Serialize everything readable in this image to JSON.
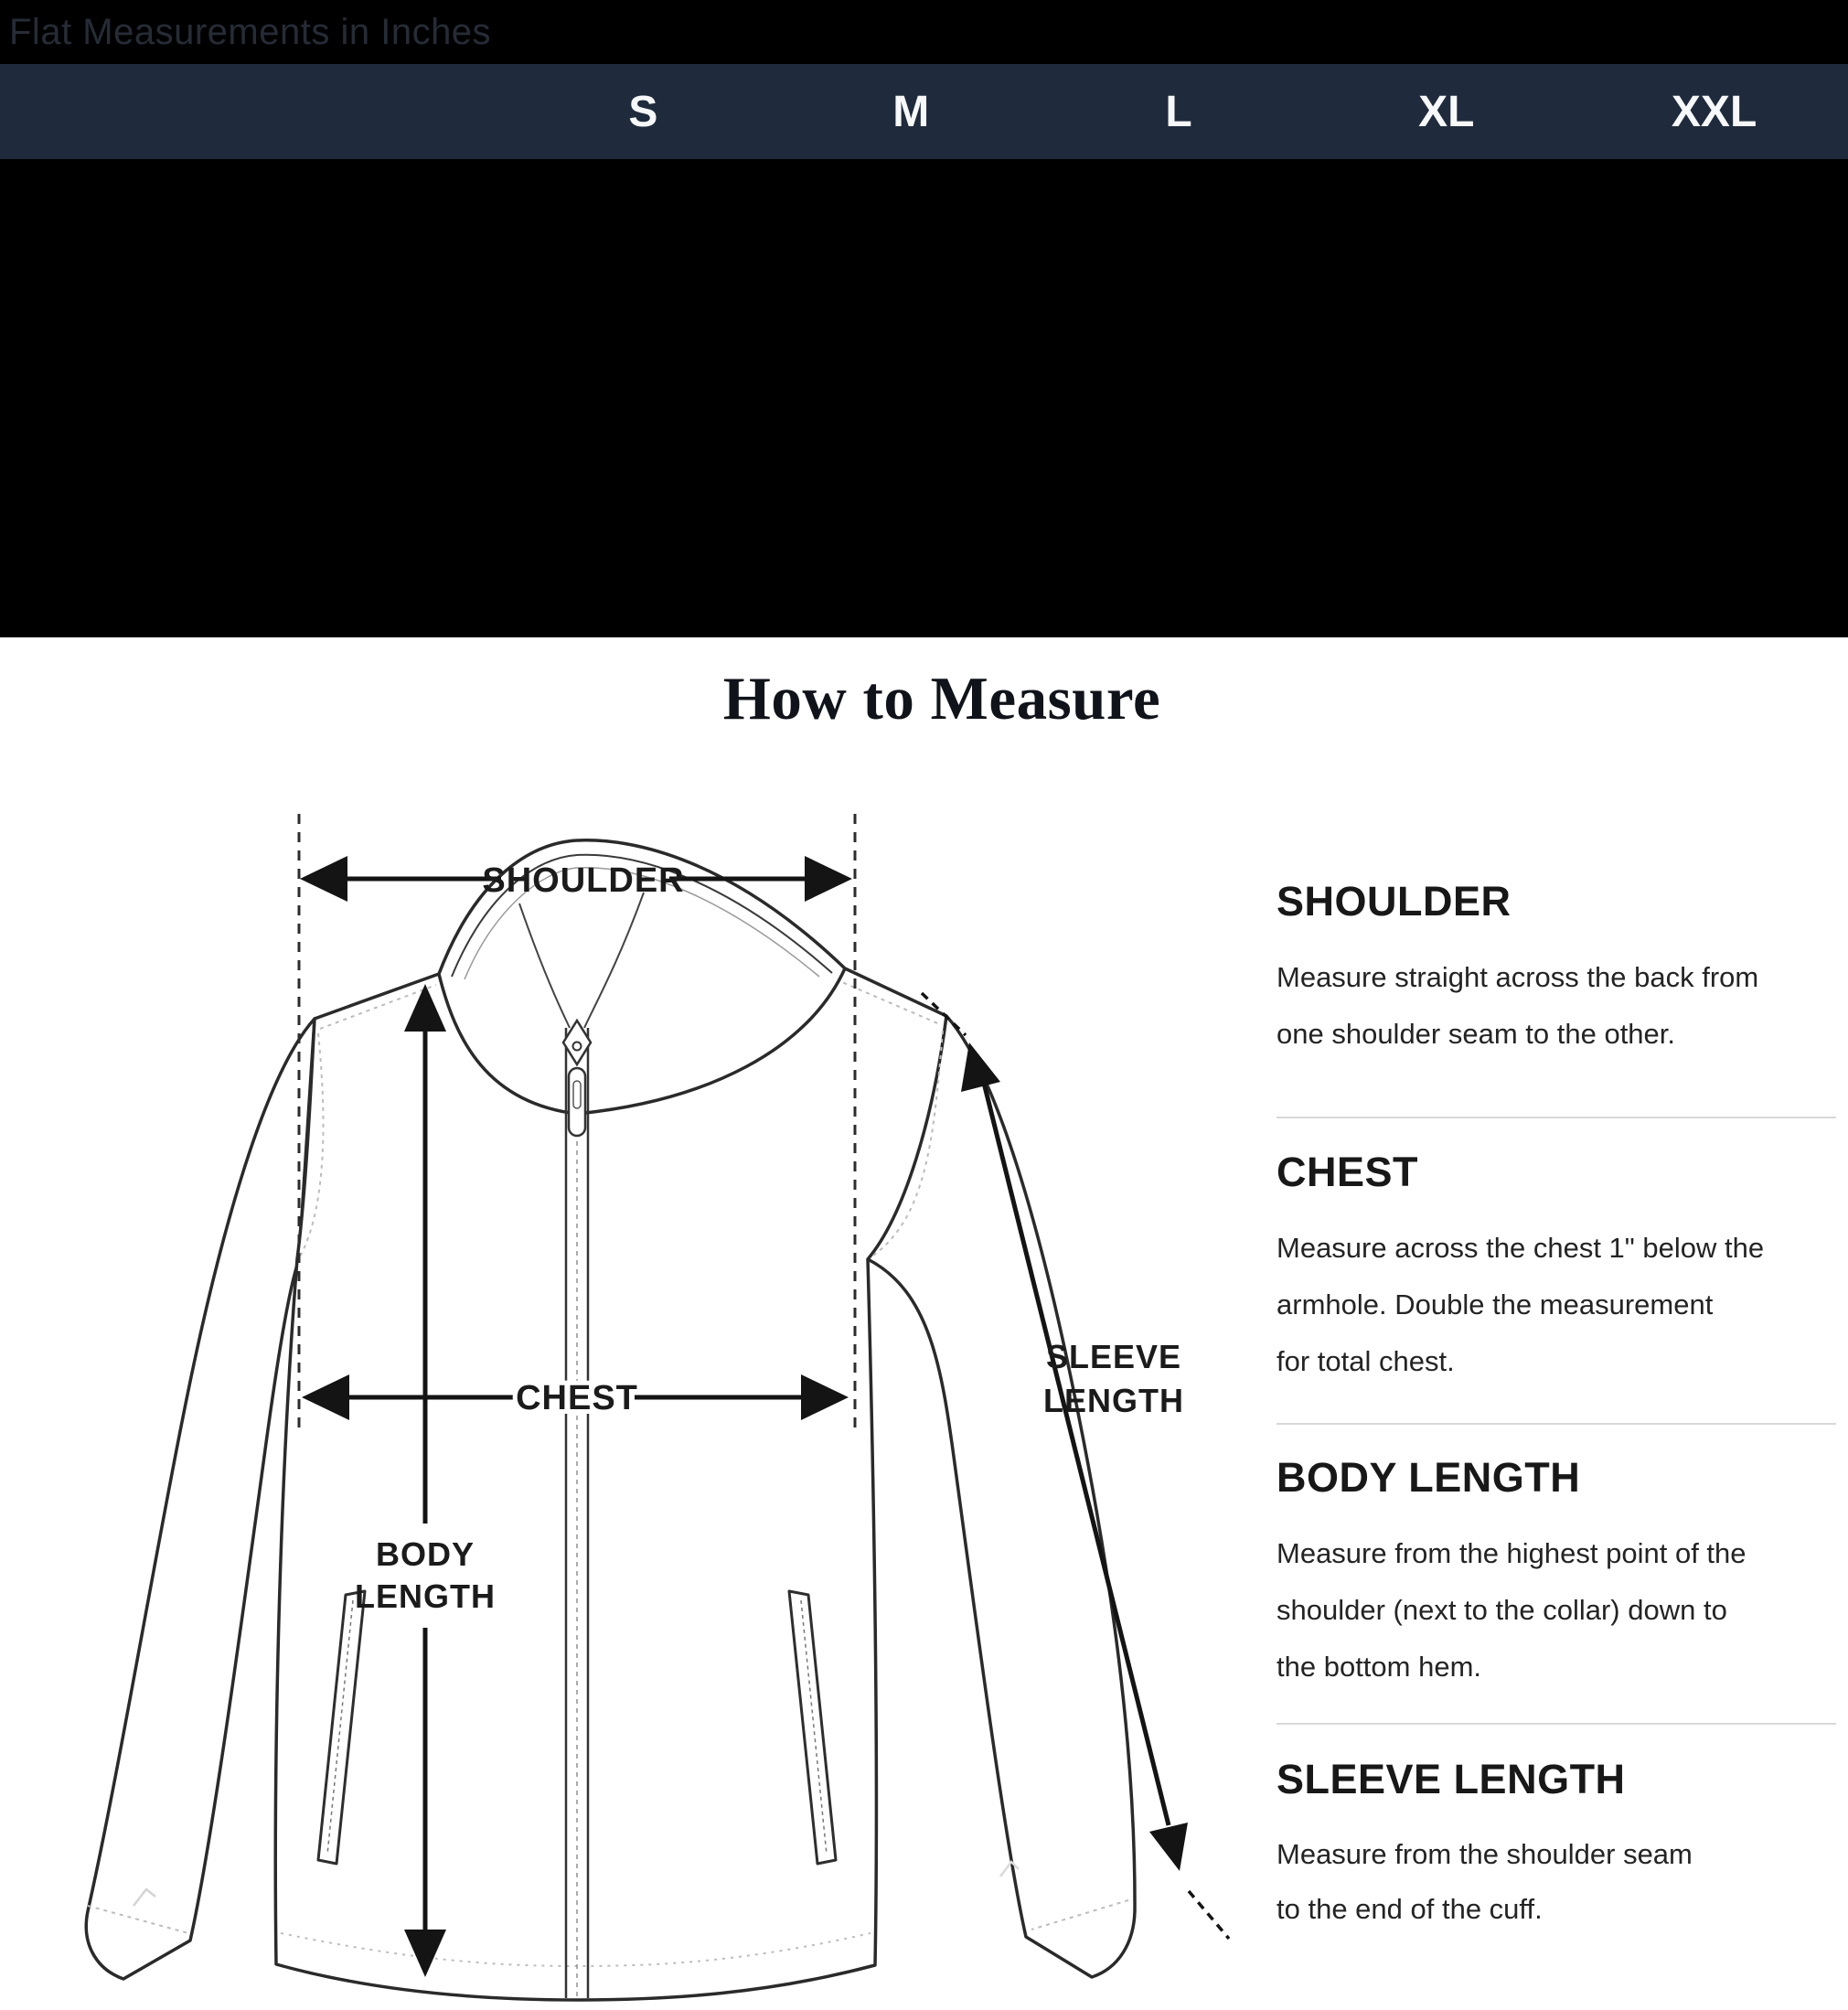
{
  "banner": {
    "label": "Flat Measurements in Inches"
  },
  "size_table": {
    "columns": [
      "S",
      "M",
      "L",
      "XL",
      "XXL"
    ]
  },
  "how_to_measure": {
    "title": "How to Measure",
    "diagram_labels": {
      "shoulder": "SHOULDER",
      "chest": "CHEST",
      "body_line1": "BODY",
      "body_line2": "LENGTH",
      "sleeve_line1": "SLEEVE",
      "sleeve_line2": "LENGTH"
    },
    "sections": [
      {
        "heading": "SHOULDER",
        "body": "Measure straight across the back from\none shoulder seam to the other."
      },
      {
        "heading": "CHEST",
        "body": "Measure across the chest 1\" below the\narmhole. Double the measurement\nfor total chest."
      },
      {
        "heading": "BODY LENGTH",
        "body": "Measure from the highest point of the\nshoulder (next to the collar) down to\nthe bottom hem."
      },
      {
        "heading": "SLEEVE LENGTH",
        "body": "Measure from the shoulder seam\nto the end of the cuff."
      }
    ]
  },
  "colors": {
    "header_bg": "#1f2b3c",
    "header_text": "#f7f8f9",
    "banner_bg": "#000000",
    "banner_text": "#262c36",
    "divider": "#d8d8d8",
    "ink": "#1b1b1b"
  }
}
